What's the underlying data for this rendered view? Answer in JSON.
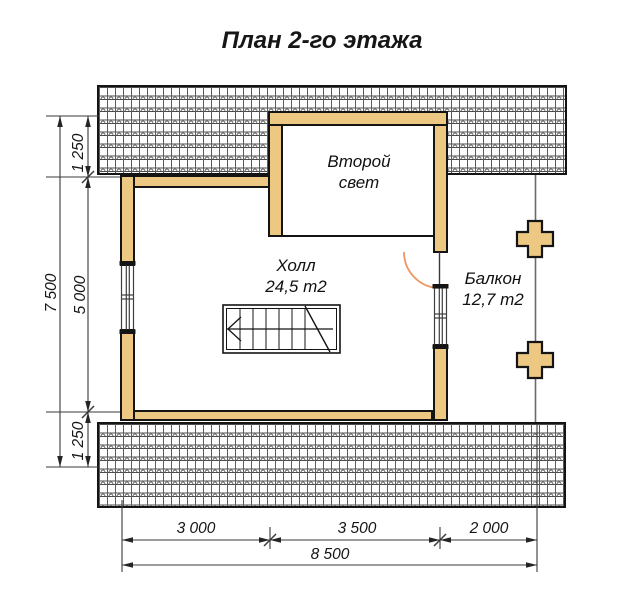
{
  "title": "План 2-го этажа",
  "rooms": {
    "second_light": {
      "line1": "Второй",
      "line2": "свет"
    },
    "hall": {
      "label": "Холл",
      "area": "24,5 m2"
    },
    "balcony": {
      "label": "Балкон",
      "area": "12,7 m2"
    }
  },
  "dimensions": {
    "vertical_total": "7 500",
    "vertical_segments": [
      "1 250",
      "5 000",
      "1 250"
    ],
    "horizontal_segments": [
      "3 000",
      "3 500",
      "2 000"
    ],
    "horizontal_total": "8 500"
  },
  "colors": {
    "wall_fill": "#edc883",
    "door_swing_arc": "#ef9560",
    "line": "#141414"
  }
}
